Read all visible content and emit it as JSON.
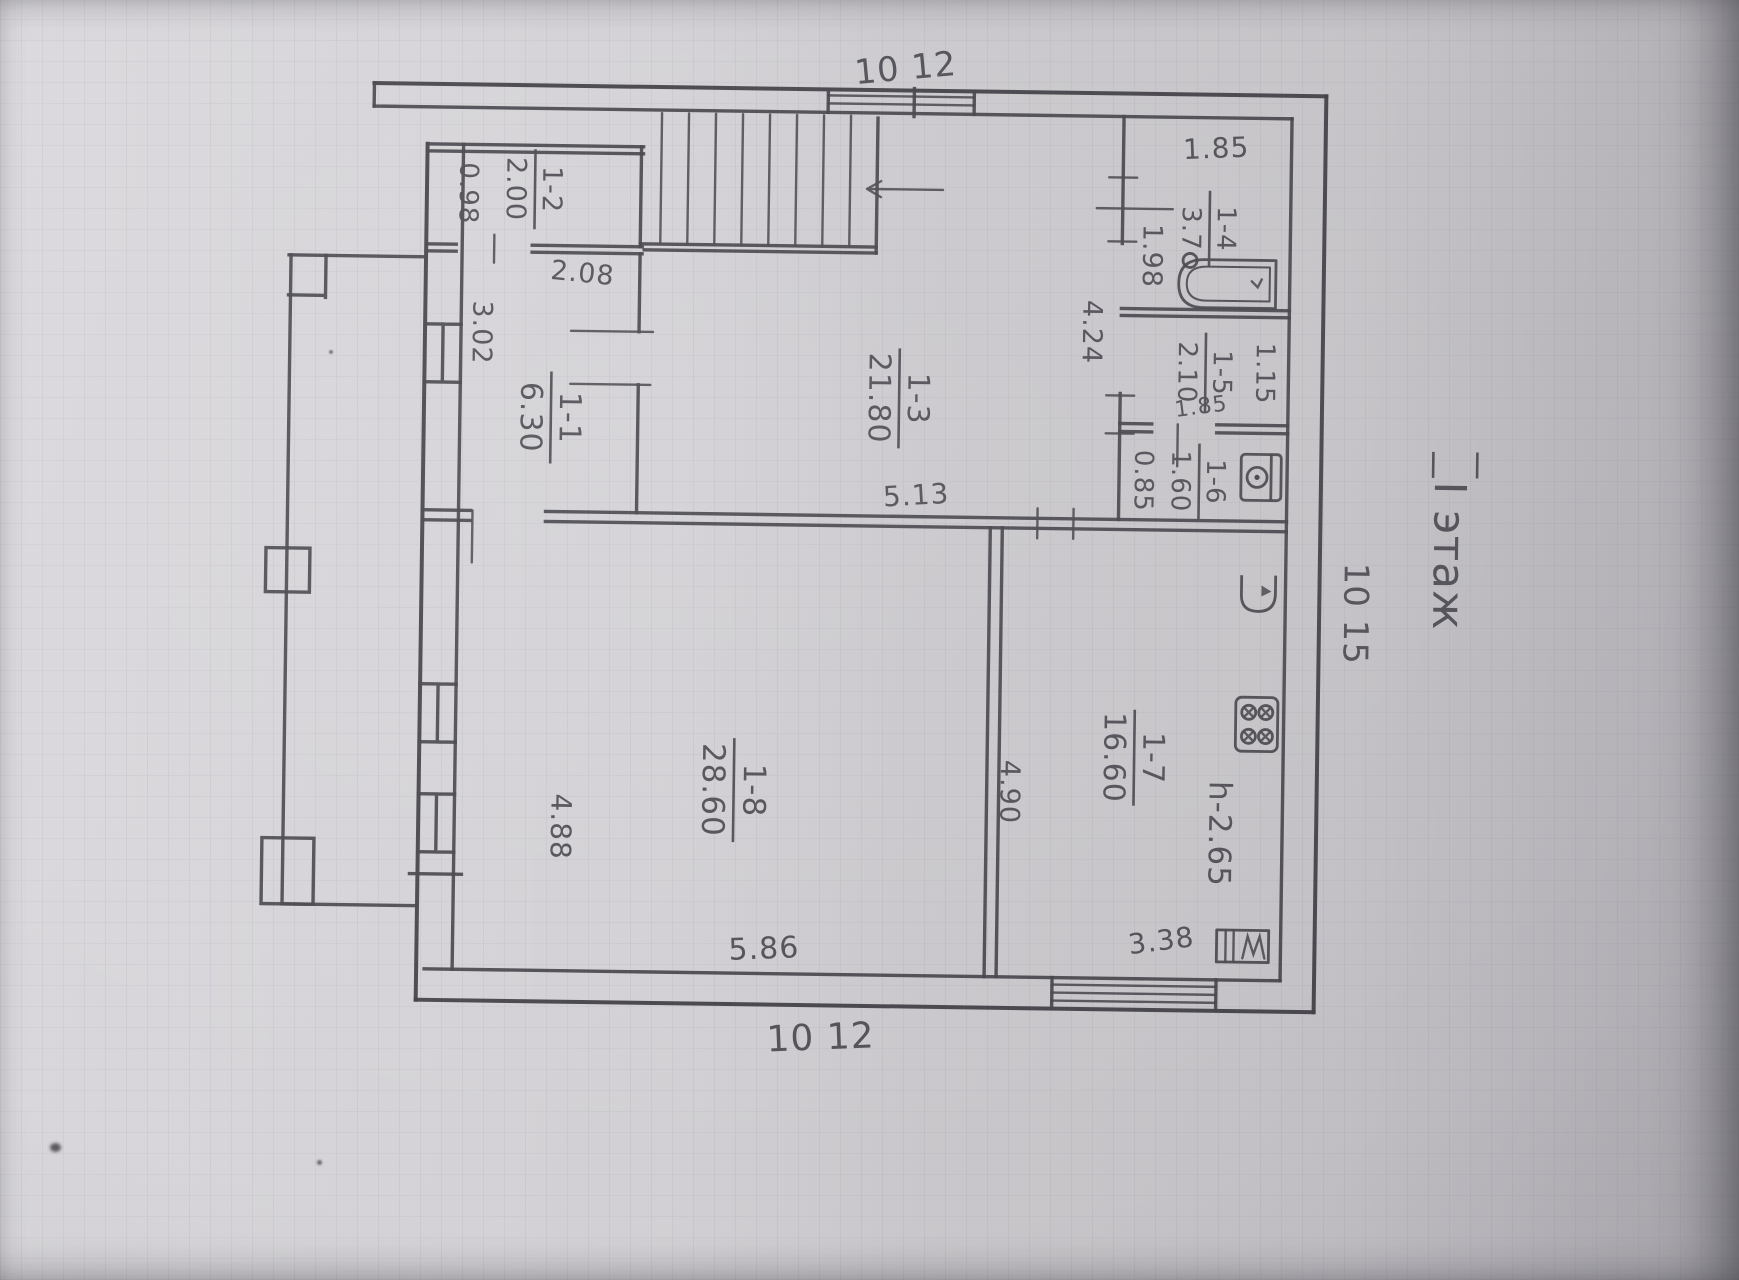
{
  "floor_title": "I этаж",
  "dims": {
    "top_width": "10 12",
    "bottom_width": "10 12",
    "right_height": "10 15",
    "stairs_width": "2.08",
    "r12_strip": "0.98",
    "r11_width": "3.02",
    "hall_width": "5.13",
    "hall_height": "4.24",
    "bath_door": "1.98",
    "bath_width": "1.85",
    "r15_width": "1.15",
    "r15_door": "1.85",
    "r16_width": "0.85",
    "r18_width": "5.86",
    "r18_wall": "4.88",
    "kitchen_wall": "4.90",
    "kitchen_width": "3.38",
    "ceiling": "h-2.65"
  },
  "rooms": {
    "r11": {
      "number": "1-1",
      "area": "6.30"
    },
    "r12": {
      "number": "1-2",
      "area": "2.00"
    },
    "r13": {
      "number": "1-3",
      "area": "21.80"
    },
    "r14": {
      "number": "1-4",
      "area": "3.7"
    },
    "r15": {
      "number": "1-5",
      "area": "2.10"
    },
    "r16": {
      "number": "1-6",
      "area": "1.60"
    },
    "r17": {
      "number": "1-7",
      "area": "16.60"
    },
    "r18": {
      "number": "1-8",
      "area": "28.60"
    }
  }
}
